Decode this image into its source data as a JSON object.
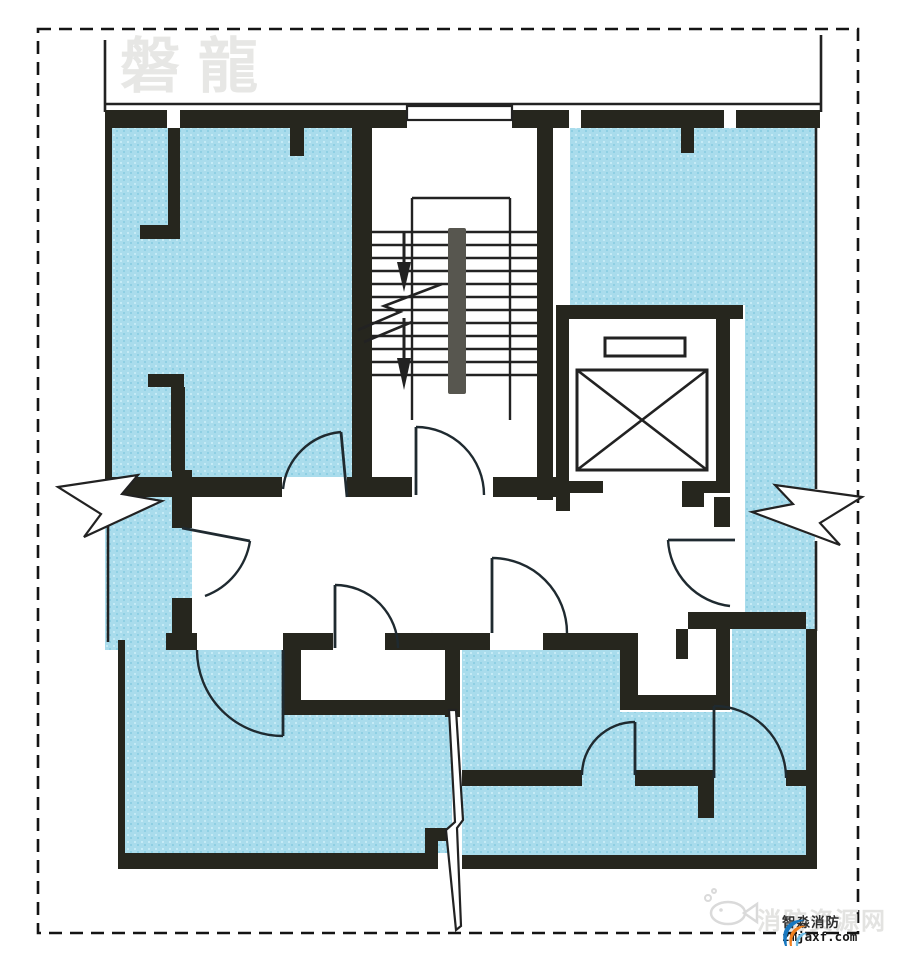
{
  "watermarks": {
    "top_left": "磐龍",
    "site": "消防资源网",
    "logo_name": "智淼消防",
    "logo_url": "zmjaxf.com"
  },
  "colors": {
    "room_fill": "#a9dcec",
    "room_dot_light": "#c6ebf6",
    "room_dot_dark": "#8ecfe3",
    "wall": "#26261e",
    "line": "#222222",
    "arc": "#1f2a30",
    "handrail": "#57564f",
    "border": "#141414",
    "watermark_gray": "#e7e7e5",
    "site_gray": "#e3e3e1",
    "logo_blue": "#1878c0",
    "logo_lightblue": "#6ebbe4",
    "logo_orange": "#f08020",
    "fish_gray": "#dadada"
  },
  "border": {
    "x": 38,
    "y": 29,
    "w": 820,
    "h": 904,
    "dash": "13 8",
    "width": 2.6
  },
  "plan": {
    "blue_regions": [
      "M112,128 H352 V477 H112 Z",
      "M105,477 H192 V650 H105 Z",
      "M124,650 H283 V715 H452 V853 H124 Z",
      "M570,128 H815 V305 H570 Z",
      "M745,305 H815 V855 H745 Z",
      "M462,650 H620 V712 H732 V629 H806 V855 H462 Z"
    ],
    "wall_rects": [
      [
        105,
        110,
        62,
        18
      ],
      [
        180,
        110,
        227,
        18
      ],
      [
        512,
        110,
        57,
        18
      ],
      [
        581,
        110,
        143,
        18
      ],
      [
        736,
        110,
        84,
        18
      ],
      [
        290,
        128,
        14,
        28
      ],
      [
        681,
        128,
        13,
        25
      ],
      [
        105,
        110,
        7,
        373
      ],
      [
        168,
        128,
        12,
        104
      ],
      [
        140,
        225,
        40,
        14
      ],
      [
        148,
        374,
        36,
        13
      ],
      [
        171,
        387,
        14,
        84
      ],
      [
        352,
        110,
        20,
        387
      ],
      [
        537,
        110,
        16,
        390
      ],
      [
        112,
        477,
        170,
        20
      ],
      [
        347,
        477,
        65,
        20
      ],
      [
        493,
        477,
        63,
        20
      ],
      [
        556,
        305,
        187,
        14
      ],
      [
        556,
        319,
        13,
        162
      ],
      [
        716,
        319,
        14,
        162
      ],
      [
        172,
        470,
        20,
        58
      ],
      [
        172,
        598,
        20,
        37
      ],
      [
        166,
        633,
        31,
        17
      ],
      [
        283,
        633,
        50,
        17
      ],
      [
        385,
        633,
        105,
        17
      ],
      [
        543,
        633,
        77,
        17
      ],
      [
        688,
        612,
        118,
        17
      ],
      [
        676,
        629,
        12,
        30
      ],
      [
        714,
        497,
        16,
        30
      ],
      [
        283,
        633,
        18,
        82
      ],
      [
        283,
        700,
        177,
        15
      ],
      [
        445,
        633,
        15,
        84
      ],
      [
        620,
        633,
        18,
        72
      ],
      [
        620,
        695,
        110,
        15
      ],
      [
        716,
        629,
        14,
        70
      ],
      [
        118,
        640,
        7,
        220
      ],
      [
        118,
        853,
        320,
        16
      ],
      [
        425,
        828,
        28,
        13
      ],
      [
        425,
        828,
        13,
        27
      ],
      [
        462,
        855,
        344,
        14
      ],
      [
        806,
        629,
        11,
        240
      ],
      [
        462,
        770,
        120,
        16
      ],
      [
        635,
        770,
        63,
        16
      ],
      [
        698,
        770,
        16,
        48
      ],
      [
        786,
        770,
        20,
        16
      ]
    ],
    "wall_paths": [
      "M556,481 h47 v12 h-33 v18 h-14 z",
      "M682,481 h48 v12 h-26 v14 h-22 z"
    ],
    "thin_lines": [
      [
        105,
        40,
        105,
        112
      ],
      [
        105,
        104,
        821,
        104
      ],
      [
        821,
        35,
        821,
        112
      ],
      [
        816,
        112,
        816,
        489
      ],
      [
        816,
        541,
        816,
        631
      ],
      [
        108,
        483,
        108,
        642
      ]
    ],
    "stairs": {
      "treads": {
        "x1": 372,
        "x2": 537,
        "y0": 232,
        "dy": 13,
        "count": 12
      },
      "landing_lines": [
        [
          412,
          198,
          412,
          420
        ],
        [
          510,
          198,
          510,
          420
        ],
        [
          412,
          198,
          510,
          198
        ]
      ],
      "handrail": [
        448,
        228,
        18,
        166
      ],
      "window": [
        407,
        106,
        105,
        14
      ],
      "zigzags": [
        "358,330 400,312 384,306 442,284",
        "364,342 412,322"
      ],
      "arrows": [
        {
          "line": [
            404,
            232,
            404,
            264
          ],
          "head": "397,262 411,262 404,292"
        },
        {
          "line": [
            404,
            318,
            404,
            360
          ],
          "head": "397,358 411,358 404,390"
        }
      ]
    },
    "elevator": {
      "car": [
        577,
        370,
        130,
        100
      ],
      "counterweight": [
        605,
        338,
        80,
        18
      ]
    },
    "doors": [
      {
        "leaf": [
          341,
          432,
          347,
          497
        ],
        "arc": "M283,489 A64,64 0 0 1 341,432"
      },
      {
        "leaf": [
          416,
          427,
          416,
          495
        ],
        "arc": "M416,427 A68,68 0 0 1 484,495"
      },
      {
        "leaf": [
          182,
          528,
          250,
          541
        ],
        "arc": "M250,541 A70,70 0 0 1 205,596"
      },
      {
        "leaf": [
          335,
          585,
          335,
          648
        ],
        "arc": "M335,585 A63,63 0 0 1 398,648"
      },
      {
        "leaf": [
          492,
          558,
          492,
          633
        ],
        "arc": "M492,558 A75,75 0 0 1 567,633"
      },
      {
        "leaf": [
          735,
          540,
          668,
          540
        ],
        "arc": "M668,540 A70,70 0 0 0 730,606"
      },
      {
        "leaf": [
          283,
          650,
          283,
          736
        ],
        "arc": "M197,650 A86,86 0 0 0 283,736"
      },
      {
        "leaf": [
          635,
          722,
          635,
          775
        ],
        "arc": "M582,775 A53,53 0 0 1 635,722"
      },
      {
        "leaf": [
          714,
          706,
          714,
          778
        ],
        "arc": "M714,706 A72,72 0 0 1 786,778"
      }
    ],
    "breaks": [
      "M58,487 L138,475 L122,494 L162,501 L84,537 L101,514 Z",
      "M862,497 L775,485 L793,504 L752,512 L840,545 L820,523 Z",
      "M449,710 L455,822 L446,830 L456,930 L461,926 L457,828 L463,820 L456,710 Z"
    ]
  }
}
